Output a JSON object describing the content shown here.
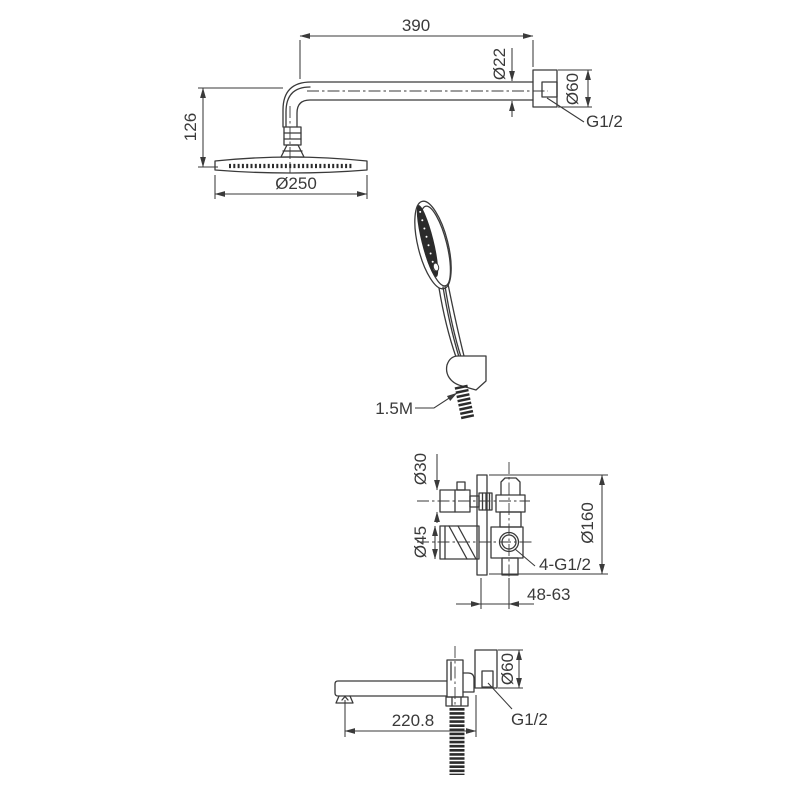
{
  "colors": {
    "background": "#ffffff",
    "line": "#3a3a3a",
    "dark_fill": "#2b2b2b"
  },
  "overhead_shower": {
    "arm_length": "390",
    "arm_diameter": "Ø22",
    "flange_diameter": "Ø60",
    "thread": "G1/2",
    "drop_height": "126",
    "head_diameter": "Ø250"
  },
  "hand_shower": {
    "hose_length": "1.5M"
  },
  "mixer_valve": {
    "knob_diameter": "Ø30",
    "handle_diameter": "Ø45",
    "plate_diameter": "Ø160",
    "ports": "4-G1/2",
    "wall_depth_range": "48-63"
  },
  "spout": {
    "reach": "220.8",
    "flange_diameter": "Ø60",
    "thread": "G1/2"
  }
}
